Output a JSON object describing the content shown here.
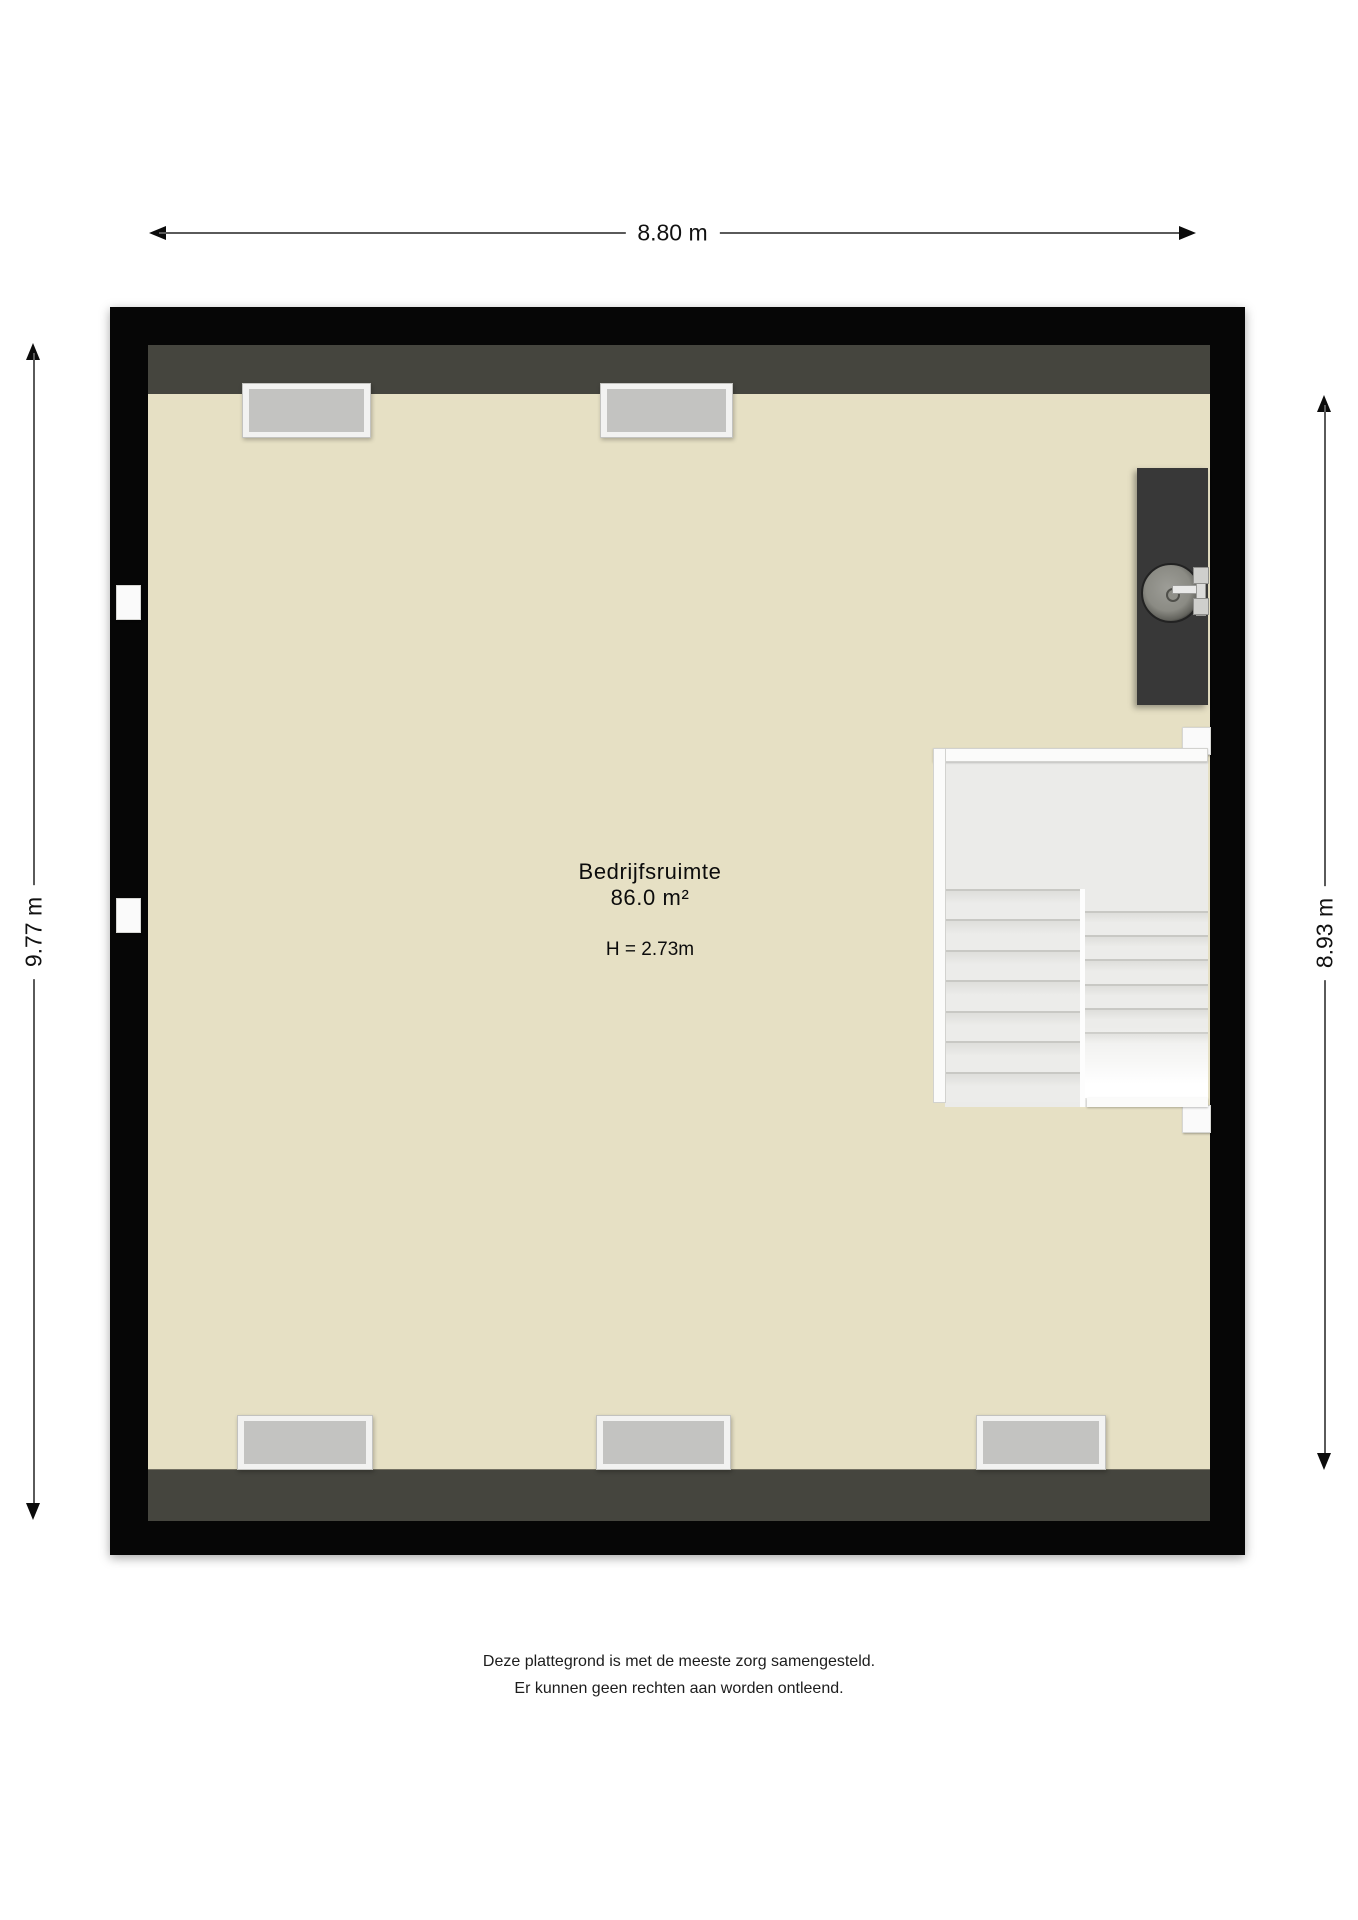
{
  "title": "Plattegrond Bedrijfsruimte",
  "dimensions": {
    "top": "8.80 m",
    "left": "9.77 m",
    "right": "8.93 m"
  },
  "room": {
    "name": "Bedrijfsruimte",
    "area": "86.0 m²",
    "ceiling_height": "H = 2.73m"
  },
  "stairs": {
    "left_flight_steps": 7,
    "right_flight_steps": 6
  },
  "windows": {
    "top_wall": 2,
    "bottom_wall": 3
  },
  "fixtures": {
    "sink": "round sink with faucet on dark counter"
  },
  "footer": {
    "line1": "Deze plattegrond is met de meeste zorg samengesteld.",
    "line2": "Er kunnen geen rechten aan worden ontleend."
  },
  "colors": {
    "floor": "#e6e0c4",
    "wall_outer": "#060606",
    "wall_inner": "#45453e",
    "window_glass": "#c3c3c1",
    "window_frame": "#f2f2f1",
    "stair_tread": "#ebebe9",
    "counter": "#383838",
    "dimension_line": "#5a5a5a"
  }
}
